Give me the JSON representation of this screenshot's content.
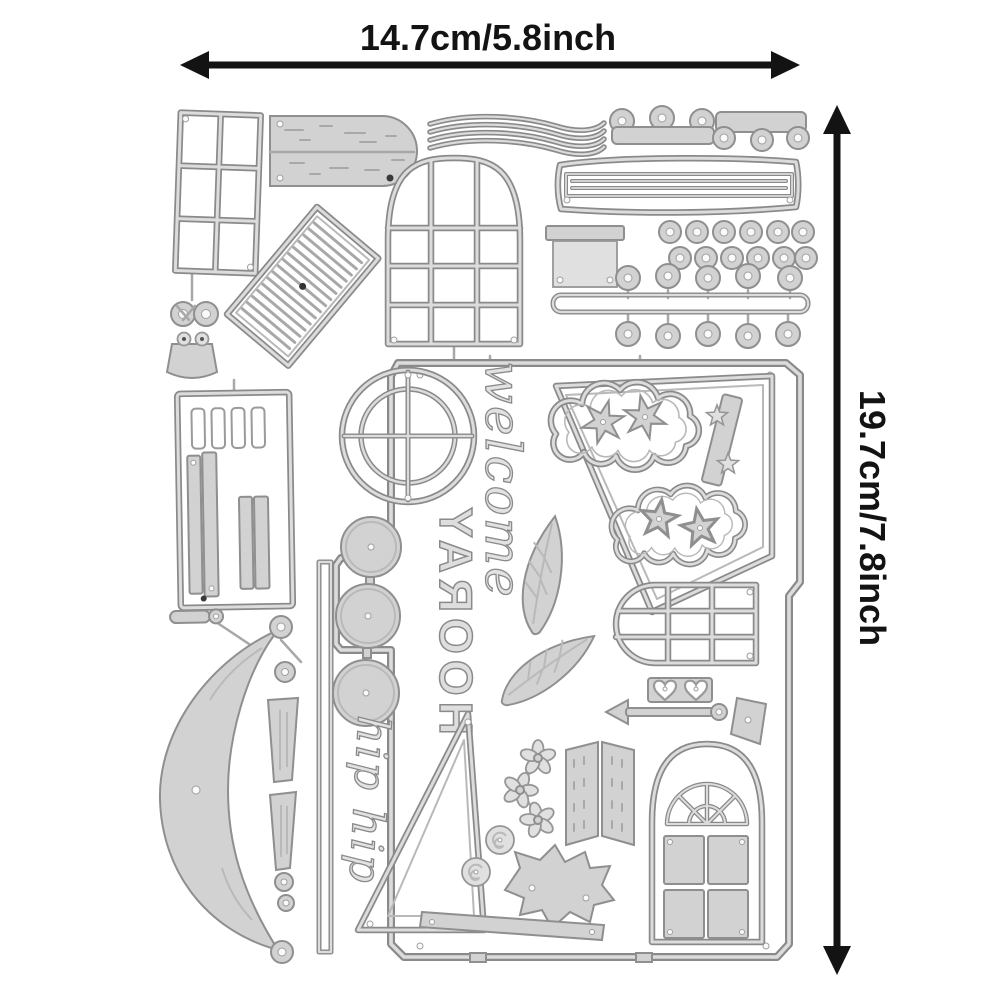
{
  "annotations": {
    "width_label": "14.7cm/5.8inch",
    "height_label": "19.7cm/7.8inch"
  },
  "word_dies": {
    "hooray": "HOORAY",
    "welcome": "welcome",
    "hip_hip": "hip hip"
  },
  "colors": {
    "background": "#ffffff",
    "die_fill": "#d2d2d2",
    "die_fill_light": "#e0e0e0",
    "die_outline": "#8a8a8a",
    "die_highlight": "#dcdcdc",
    "annotation_ink": "#131313"
  },
  "dies": [
    "six-pane-window",
    "wood-plank-sign",
    "wavy-ribbon",
    "scalloped-trim-knobs-up",
    "scalloped-trim-knobs-down",
    "lined-banner",
    "louvered-shutter",
    "arched-grid-window",
    "chimney-box",
    "berry-dot-rows",
    "knob-rail",
    "bow-charm",
    "slotted-plank-panel",
    "awning-crescent",
    "tassel-drops",
    "house-plate",
    "left-rail",
    "porthole-window",
    "welcome-script-die",
    "star-cloud-frame",
    "cloud-with-flowers",
    "star-strip",
    "cloud-with-stars",
    "stepping-circles",
    "hooray-word-die",
    "fern-leaf-large",
    "fern-leaf-small",
    "rounded-grid-window",
    "heart-buttons",
    "arrow-rod",
    "hand-trowel",
    "hip-hip-script-die",
    "gable-triangle",
    "flower-chain",
    "rose-buds",
    "stitched-shutter-pair",
    "holly-leaf-cluster",
    "arched-panel-door",
    "bottom-rail"
  ]
}
